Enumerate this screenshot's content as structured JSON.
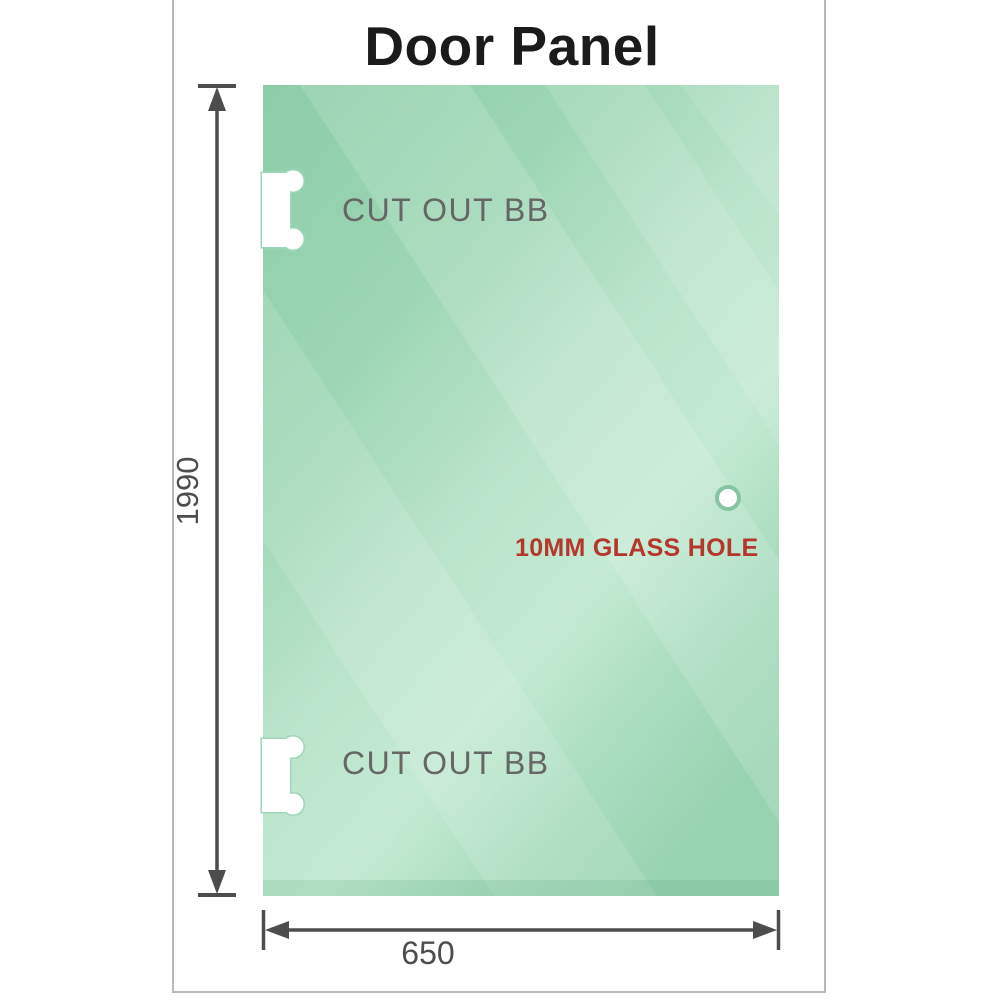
{
  "title": "Door Panel",
  "panel": {
    "cutouts": [
      {
        "label": "CUT OUT BB"
      },
      {
        "label": "CUT OUT BB"
      }
    ],
    "hole_label": "10MM GLASS HOLE"
  },
  "dimensions": {
    "height": "1990",
    "width": "650"
  },
  "colors": {
    "glass_green_dark": "#8ccda8",
    "glass_green_light": "#c4ead3",
    "cutout_label_gray": "#666666",
    "dimension_gray": "#4d4d4d",
    "hole_label_red": "#b5372c",
    "frame_border_gray": "#b8b8b8",
    "title_color": "#1b1b1b"
  }
}
